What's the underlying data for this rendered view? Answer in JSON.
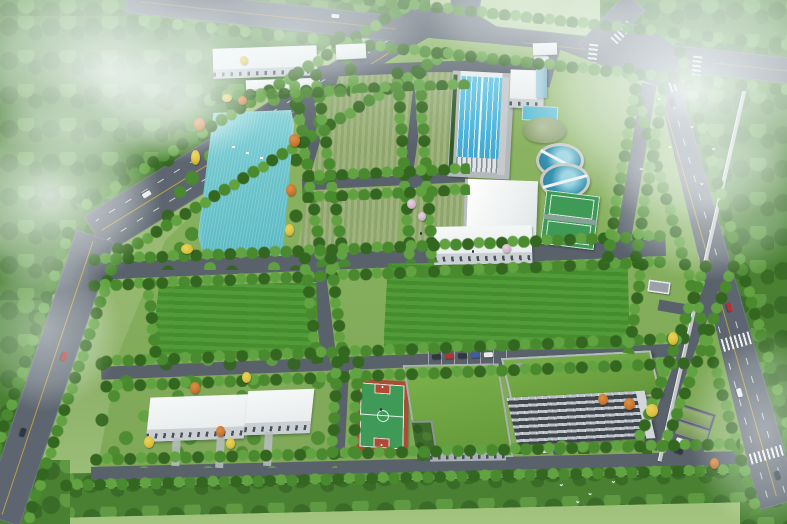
{
  "meta": {
    "description": "Aerial perspective architectural rendering of a water treatment plant campus bordered by tree-lined roads, with fog clouds drifting over the corners and birds in flight",
    "image_type": "3D rendering, bird's-eye view",
    "canvas": {
      "width_px": 787,
      "height_px": 524
    }
  },
  "palette": {
    "fog": "#f0f6f7",
    "grassBase": "#9cbd76",
    "grassLight": "#b4d095",
    "grassSite": "#84ae5c",
    "lawn": "#4a9630",
    "field": "#96ad72",
    "forest1": "#3a6c28",
    "forest2": "#498032",
    "forest3": "#5f9a42",
    "tree1": "#33661f",
    "tree2": "#4a8a2e",
    "tree3": "#62a341",
    "roadOuter": "#5d6670",
    "roadInner": "#59616b",
    "roadLine": "#c8a83c",
    "wall": "#cdd1d3",
    "pond": "#6fc6cd",
    "basin": "#49b4da",
    "clarifier": "#3a93b2",
    "concrete": "#b4babc",
    "white": "#eef1f1",
    "face": "#c9cfd3",
    "shadow": "#a9b0b5",
    "win": "#49525a",
    "roofGreen": "#6ba23d",
    "courtGreen": "#3f9a57",
    "courtRed": "#ae4a36",
    "towerGlass": "#8fc4d6",
    "autumnO": "#c5742e",
    "autumnY": "#d9bf3c",
    "blossom": "#cfaec6",
    "carRed": "#b23434",
    "carDark": "#2f3741",
    "carWhite": "#e9ebeb",
    "carBlue": "#3a5da8",
    "domeA": "#aebd95",
    "domeB": "#7a9160"
  },
  "scene": {
    "environment": {
      "fog_clouds": 9,
      "birds_in_flight": 10,
      "surrounding": "dense forest belts outside the road ring"
    },
    "roads": [
      {
        "name": "west-avenue",
        "markings": [
          "yellow centerline",
          "white lane dashes",
          "zebra crossing"
        ],
        "vehicles": 6
      },
      {
        "name": "north-road",
        "markings": [
          "centerline"
        ],
        "vehicles": 4
      },
      {
        "name": "east-road",
        "markings": [
          "yellow centerline",
          "white lane dashes",
          "two zebra crossings"
        ],
        "vehicles": 5
      },
      {
        "name": "north-crossroads",
        "markings": [
          "zebra crossings on all legs"
        ]
      }
    ],
    "facility": {
      "type": "water treatment plant campus",
      "features": [
        "ornamental pond with autumn trees",
        "four rectangular drying-bed lawns",
        "long sedimentation basin with lane lines",
        "two circular clarifier tanks with scraper bridges",
        "grey-green digester dome",
        "water tower with glass shaft",
        "pump house and workshop with white pitched roof",
        "two north service buildings",
        "two gatehouses on north edge",
        "east gate",
        "two large central lawns",
        "two southwest service buildings",
        "basketball court (green with red aprons)",
        "multi-sport courts (green with white lines)",
        "U-shaped green-roof building with courtyard",
        "green-roof office block with glazed facade",
        "north parking row and east carport parking",
        "perimeter wall",
        "street tree rows along every internal road"
      ]
    }
  }
}
